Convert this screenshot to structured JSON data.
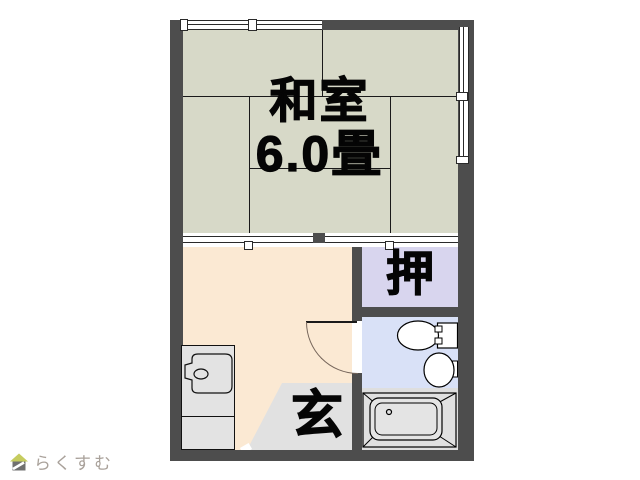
{
  "plan_type": "apartment-floorplan",
  "rooms": {
    "tatami": {
      "name_label": "和室",
      "size_label": "6.0畳",
      "color": "#d7d9c8"
    },
    "closet": {
      "label": "押",
      "color": "#d8d5ee"
    },
    "kitchen": {
      "color": "#fbe9d3"
    },
    "entrance": {
      "label": "玄",
      "color": "#e1e1e1"
    },
    "bathroom": {
      "color": "#d9e1f7"
    },
    "bath": {
      "color": "#dedede"
    }
  },
  "walls": {
    "color": "#4d4d4d"
  },
  "fixtures": {
    "kitchen_sink": "kitchen-sink-unit",
    "door": "hinged-door-swing",
    "toilet": "toilet",
    "basin": "wash-basin",
    "bathtub": "bathtub",
    "windows": "window-symbols",
    "sliding_door": "sliding-door-symbol"
  },
  "watermark": {
    "text": "らくすむ",
    "roof_color": "#c6cc5f",
    "body_color": "#707070",
    "text_color": "#a9a19a"
  }
}
